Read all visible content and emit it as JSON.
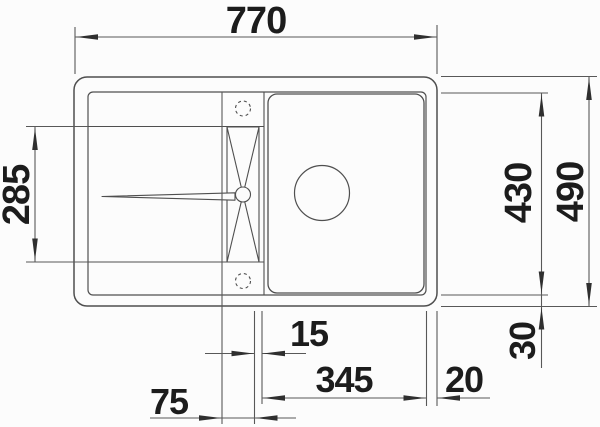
{
  "drawing": {
    "kind": "sink-installation-dimension-diagram",
    "view": "top-view technical drawing of inset kitchen sink with drainboard, tap ledge and bowl",
    "colors": {
      "background": "#fcfcfc",
      "outline": "#4f4f4f",
      "dim_line": "#585858",
      "arrow": "#2f2f2f",
      "text": "#1c1c1c"
    },
    "dimensions": {
      "total_width": "770",
      "total_depth": "490",
      "inner_depth": "430",
      "drainboard_depth": "285",
      "rear_edge_offset": "30",
      "divider_gap": "15",
      "bowl_section_width": "345",
      "side_edge_offset": "20",
      "tap_section_width": "75"
    }
  }
}
